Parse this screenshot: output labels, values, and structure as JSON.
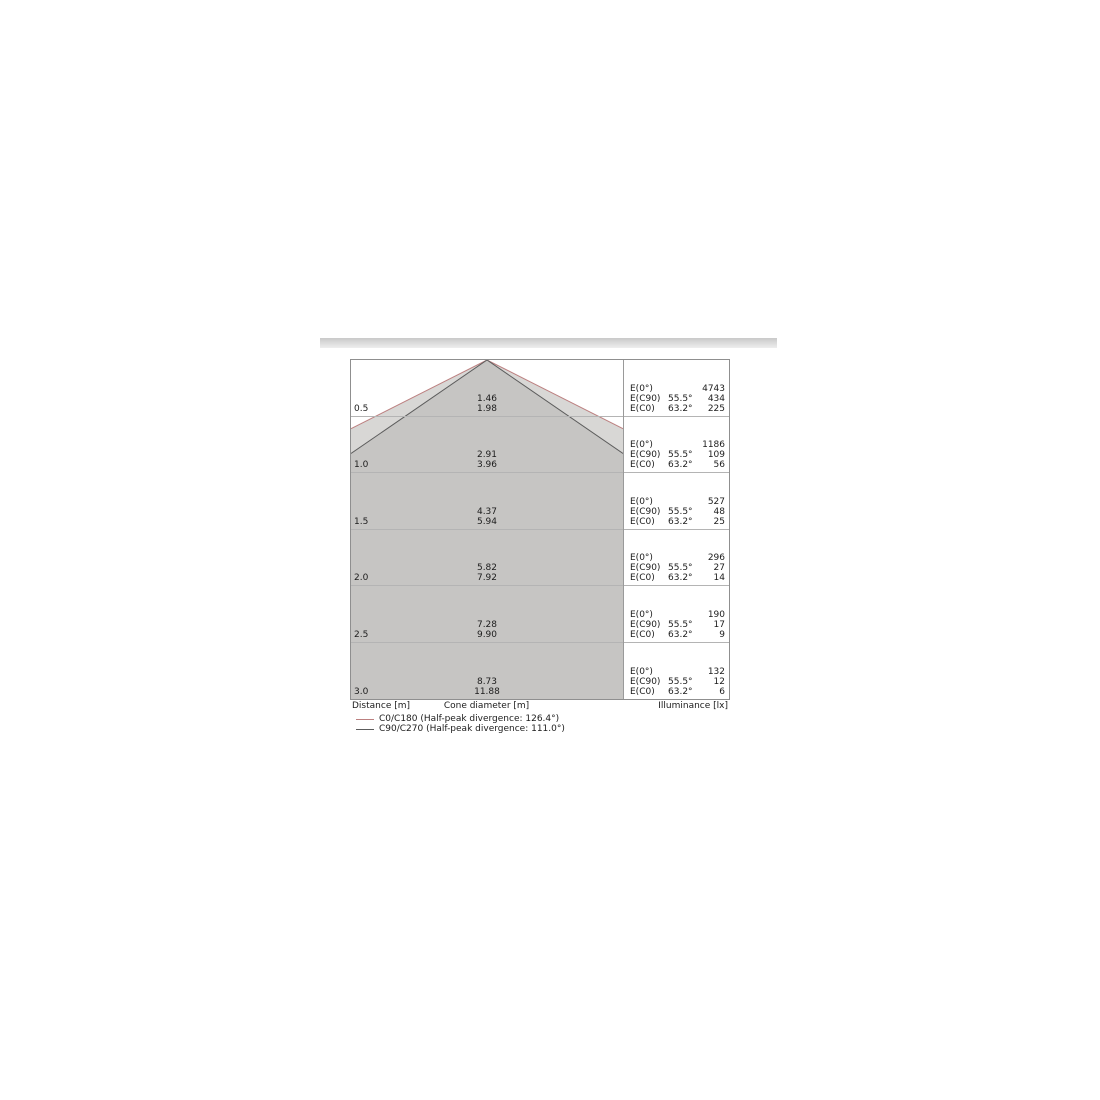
{
  "chart_data": {
    "type": "cone-diagram-table",
    "title": "Luminous cone diagram with illuminance table",
    "axis": {
      "distance": "Distance [m]",
      "cone_diameter": "Cone diameter [m]",
      "illuminance": "Illuminance [lx]"
    },
    "labels": {
      "E0": "E(0°)",
      "EC90": "E(C90)",
      "EC0": "E(C0)",
      "angle_c90": "55.5°",
      "angle_c0": "63.2°"
    },
    "rows": [
      {
        "distance": "0.5",
        "cone_diameter_c90": "1.46",
        "cone_diameter_c0": "1.98",
        "E0": "4743",
        "EC90": "434",
        "EC0": "225"
      },
      {
        "distance": "1.0",
        "cone_diameter_c90": "2.91",
        "cone_diameter_c0": "3.96",
        "E0": "1186",
        "EC90": "109",
        "EC0": "56"
      },
      {
        "distance": "1.5",
        "cone_diameter_c90": "4.37",
        "cone_diameter_c0": "5.94",
        "E0": "527",
        "EC90": "48",
        "EC0": "25"
      },
      {
        "distance": "2.0",
        "cone_diameter_c90": "5.82",
        "cone_diameter_c0": "7.92",
        "E0": "296",
        "EC90": "27",
        "EC0": "14"
      },
      {
        "distance": "2.5",
        "cone_diameter_c90": "7.28",
        "cone_diameter_c0": "9.90",
        "E0": "190",
        "EC90": "17",
        "EC0": "9"
      },
      {
        "distance": "3.0",
        "cone_diameter_c90": "8.73",
        "cone_diameter_c0": "11.88",
        "E0": "132",
        "EC90": "12",
        "EC0": "6"
      }
    ],
    "legend": [
      {
        "label": "C0/C180 (Half-peak divergence: 126.4°)",
        "color": "#bc8080"
      },
      {
        "label": "C90/C270 (Half-peak divergence: 111.0°)",
        "color": "#5c5c5c"
      }
    ],
    "colors": {
      "cone_outer_fill": "#d8d7d5",
      "cone_inner_fill": "#c6c5c3",
      "c0_line": "#bc8080",
      "c90_line": "#5c5c5c"
    },
    "axis_ranges": {
      "distance_m": [
        0,
        3.0
      ],
      "row_step_m": 0.5
    }
  }
}
